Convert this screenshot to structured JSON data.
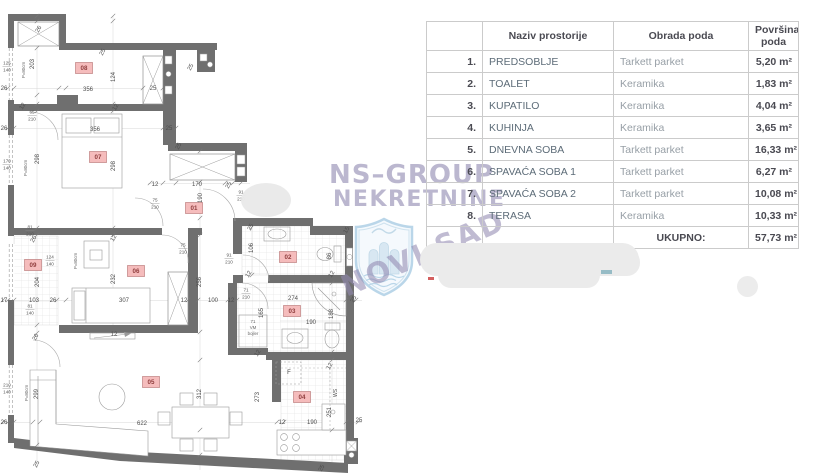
{
  "table": {
    "header": {
      "num": "",
      "name": "Naziv prostorije",
      "floor": "Obrada poda",
      "area1": "Površina",
      "area2": "poda"
    },
    "rows": [
      {
        "num": "1.",
        "name": "PREDSOBLJE",
        "floor": "Tarkett parket",
        "area": "5,20 m²"
      },
      {
        "num": "2.",
        "name": "TOALET",
        "floor": "Keramika",
        "area": "1,83 m²"
      },
      {
        "num": "3.",
        "name": "KUPATILO",
        "floor": "Keramika",
        "area": "4,04 m²"
      },
      {
        "num": "4.",
        "name": "KUHINJA",
        "floor": "Keramika",
        "area": "3,65 m²"
      },
      {
        "num": "5.",
        "name": "DNEVNA SOBA",
        "floor": "Tarkett parket",
        "area": "16,33 m²"
      },
      {
        "num": "6.",
        "name": "SPAVAĆA SOBA 1",
        "floor": "Tarkett parket",
        "area": "6,27 m²"
      },
      {
        "num": "7.",
        "name": "SPAVAĆA SOBA 2",
        "floor": "Tarkett parket",
        "area": "10,08 m²"
      },
      {
        "num": "8.",
        "name": "TERASA",
        "floor": "Keramika",
        "area": "10,33 m²"
      }
    ],
    "total": {
      "label": "UKUPNO:",
      "area": "57,73 m²"
    }
  },
  "watermark": {
    "line1": "NS–GROUP",
    "line2": "NEKRETNINE",
    "stamp": "NOVI SAD"
  },
  "colors": {
    "wall": "#6f6f6f",
    "room_label_bg": "#f5bcbc",
    "room_label_border": "#bf8080",
    "room_label_text": "#8f3d3d",
    "dim_text": "#4d4d4d",
    "watermark": "#928ab2",
    "table_border": "#cbcbcb",
    "table_dark": "#4a4a52",
    "table_slate": "#5d6c78",
    "table_gray": "#979fa6"
  },
  "floorplan": {
    "room_labels": [
      {
        "id": "01",
        "x": 194,
        "y": 208
      },
      {
        "id": "02",
        "x": 288,
        "y": 257
      },
      {
        "id": "03",
        "x": 292,
        "y": 311
      },
      {
        "id": "04",
        "x": 302,
        "y": 397
      },
      {
        "id": "05",
        "x": 151,
        "y": 382
      },
      {
        "id": "06",
        "x": 136,
        "y": 271
      },
      {
        "id": "07",
        "x": 98,
        "y": 157
      },
      {
        "id": "08",
        "x": 84,
        "y": 68
      },
      {
        "id": "09",
        "x": 33,
        "y": 265
      }
    ],
    "dim_labels": [
      {
        "t": "26",
        "x": 40,
        "y": 30,
        "r": -60
      },
      {
        "t": "203",
        "x": 34,
        "y": 64,
        "r": -90
      },
      {
        "t": "26",
        "x": 4,
        "y": 90
      },
      {
        "t": "356",
        "x": 88,
        "y": 91
      },
      {
        "t": "124",
        "x": 115,
        "y": 77,
        "r": -90
      },
      {
        "t": "25",
        "x": 104,
        "y": 53,
        "r": -60
      },
      {
        "t": "25",
        "x": 153,
        "y": 90
      },
      {
        "t": "12",
        "x": 24,
        "y": 107,
        "r": -60
      },
      {
        "t": "12",
        "x": 117,
        "y": 108,
        "r": -60
      },
      {
        "t": "26",
        "x": 4,
        "y": 130
      },
      {
        "t": "356",
        "x": 95,
        "y": 131
      },
      {
        "t": "25",
        "x": 169,
        "y": 130
      },
      {
        "t": "298",
        "x": 39,
        "y": 159,
        "r": -90
      },
      {
        "t": "298",
        "x": 115,
        "y": 166,
        "r": -90
      },
      {
        "t": "25",
        "x": 180,
        "y": 147,
        "r": -60
      },
      {
        "t": "25",
        "x": 192,
        "y": 68,
        "r": -60
      },
      {
        "t": "12",
        "x": 155,
        "y": 186
      },
      {
        "t": "170",
        "x": 197,
        "y": 186
      },
      {
        "t": "25",
        "x": 230,
        "y": 186,
        "r": -60
      },
      {
        "t": "190",
        "x": 202,
        "y": 198,
        "r": -90
      },
      {
        "t": "25",
        "x": 252,
        "y": 228,
        "r": -60
      },
      {
        "t": "15",
        "x": 348,
        "y": 231,
        "r": -60
      },
      {
        "t": "106",
        "x": 253,
        "y": 248,
        "r": -90
      },
      {
        "t": "86",
        "x": 331,
        "y": 256,
        "r": -90
      },
      {
        "t": "12",
        "x": 250,
        "y": 275,
        "r": -60
      },
      {
        "t": "12",
        "x": 333,
        "y": 275,
        "r": -60
      },
      {
        "t": "165",
        "x": 263,
        "y": 313,
        "r": -90
      },
      {
        "t": "274",
        "x": 293,
        "y": 300
      },
      {
        "t": "190",
        "x": 311,
        "y": 324
      },
      {
        "t": "188",
        "x": 333,
        "y": 314,
        "r": -90
      },
      {
        "t": "25",
        "x": 355,
        "y": 300,
        "r": -60
      },
      {
        "t": "12",
        "x": 259,
        "y": 354,
        "r": -60
      },
      {
        "t": "12",
        "x": 331,
        "y": 367,
        "r": -60
      },
      {
        "t": "F",
        "x": 289,
        "y": 374
      },
      {
        "t": "WS",
        "x": 337,
        "y": 393,
        "r": -90,
        "s": 5
      },
      {
        "t": "251",
        "x": 331,
        "y": 412,
        "r": -90
      },
      {
        "t": "190",
        "x": 312,
        "y": 424
      },
      {
        "t": "12",
        "x": 282,
        "y": 424
      },
      {
        "t": "25",
        "x": 359,
        "y": 422
      },
      {
        "t": "273",
        "x": 259,
        "y": 397,
        "r": -90
      },
      {
        "t": "17",
        "x": 4,
        "y": 302
      },
      {
        "t": "103",
        "x": 34,
        "y": 302
      },
      {
        "t": "26",
        "x": 53,
        "y": 302
      },
      {
        "t": "307",
        "x": 124,
        "y": 302
      },
      {
        "t": "12",
        "x": 184,
        "y": 302
      },
      {
        "t": "100",
        "x": 213,
        "y": 302
      },
      {
        "t": "12",
        "x": 231,
        "y": 302
      },
      {
        "t": "26",
        "x": 35,
        "y": 240,
        "r": -60
      },
      {
        "t": "12",
        "x": 115,
        "y": 239,
        "r": -60
      },
      {
        "t": "204",
        "x": 39,
        "y": 282,
        "r": -90
      },
      {
        "t": "232",
        "x": 115,
        "y": 279,
        "r": -90
      },
      {
        "t": "256",
        "x": 201,
        "y": 282,
        "r": -90
      },
      {
        "t": "26",
        "x": 37,
        "y": 338,
        "r": -60
      },
      {
        "t": "12",
        "x": 114,
        "y": 336
      },
      {
        "t": "299",
        "x": 38,
        "y": 394,
        "r": -90
      },
      {
        "t": "312",
        "x": 201,
        "y": 394,
        "r": -90
      },
      {
        "t": "622",
        "x": 142,
        "y": 425
      },
      {
        "t": "26",
        "x": 4,
        "y": 424
      },
      {
        "t": "25",
        "x": 38,
        "y": 465,
        "r": -60
      },
      {
        "t": "25",
        "x": 323,
        "y": 469,
        "r": -60
      }
    ],
    "frac_labels": [
      {
        "a": "125",
        "b": "140",
        "x": 7,
        "y": 66
      },
      {
        "a": "170",
        "b": "140",
        "x": 7,
        "y": 164
      },
      {
        "a": "210",
        "b": "140",
        "x": 7,
        "y": 388
      },
      {
        "a": "65",
        "b": "210",
        "x": 32,
        "y": 115
      },
      {
        "a": "81",
        "b": "210",
        "x": 30,
        "y": 230
      },
      {
        "a": "81",
        "b": "140",
        "x": 30,
        "y": 309
      },
      {
        "a": "124",
        "b": "140",
        "x": 50,
        "y": 260
      },
      {
        "a": "75",
        "b": "210",
        "x": 155,
        "y": 203
      },
      {
        "a": "75",
        "b": "210",
        "x": 183,
        "y": 248
      },
      {
        "a": "91",
        "b": "210",
        "x": 241,
        "y": 195
      },
      {
        "a": "91",
        "b": "210",
        "x": 229,
        "y": 258
      },
      {
        "a": "71",
        "b": "210",
        "x": 246,
        "y": 293
      }
    ],
    "notes": [
      {
        "t": "P=80cm",
        "x": 25,
        "y": 70,
        "r": -90
      },
      {
        "t": "P=80cm",
        "x": 27,
        "y": 168,
        "r": -90
      },
      {
        "t": "P=80cm",
        "x": 77,
        "y": 261,
        "r": -90
      },
      {
        "t": "P=80cm",
        "x": 28,
        "y": 393,
        "r": -90
      },
      {
        "t": "71",
        "x": 253,
        "y": 323
      },
      {
        "t": "VM",
        "x": 253,
        "y": 329
      },
      {
        "t": "bojler",
        "x": 253,
        "y": 335
      }
    ]
  }
}
